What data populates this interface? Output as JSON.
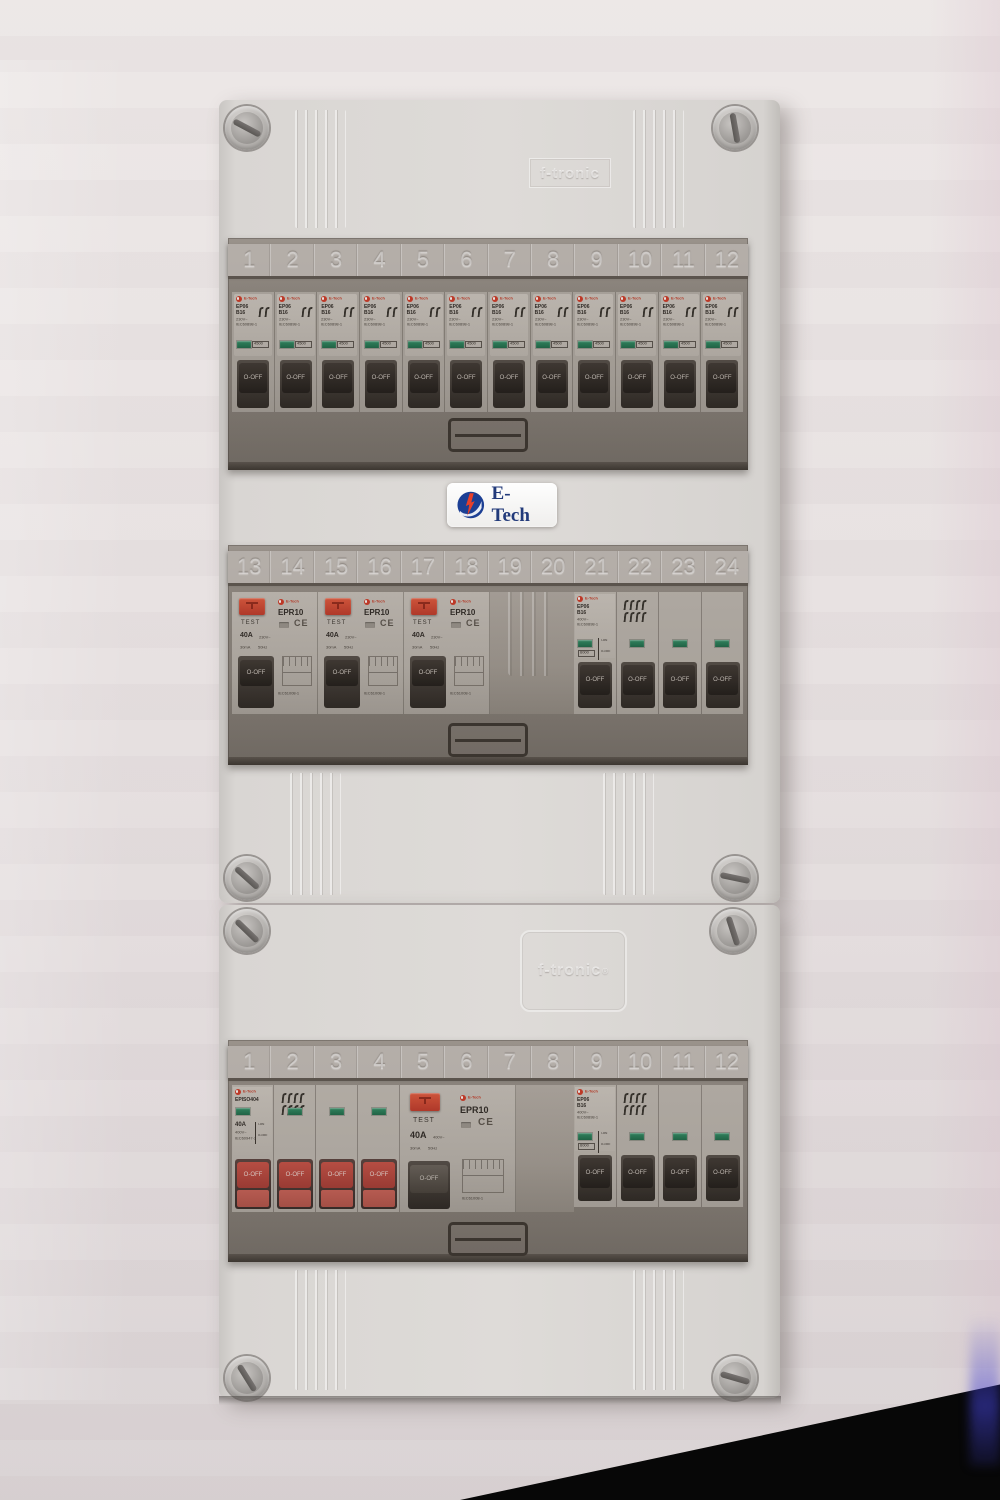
{
  "enclosure": {
    "brand_emboss": "f-tronic",
    "brand_emboss_reg": "®",
    "badge_text": "E-Tech"
  },
  "colors": {
    "accent_red_logo": "#c33a26",
    "test_button_red": "#d8432f",
    "toggle_black": "#262220",
    "toggle_red": "#c24a43",
    "indicator_green": "#2f9067",
    "enclosure_gray": "#d9d6d3",
    "badge_blue": "#1c3f94"
  },
  "top_row": {
    "slots": [
      "1",
      "2",
      "3",
      "4",
      "5",
      "6",
      "7",
      "8",
      "9",
      "10",
      "11",
      "12"
    ],
    "breaker": {
      "count": 12,
      "brand": "E-Tech",
      "model": "EP06",
      "rating": "B16",
      "voltage": "230V~",
      "standard": "IEC60898-1",
      "breaking_capacity": "4500",
      "toggle_label": "O-OFF"
    }
  },
  "middle_row": {
    "slots": [
      "13",
      "14",
      "15",
      "16",
      "17",
      "18",
      "19",
      "20",
      "21",
      "22",
      "23",
      "24"
    ],
    "rcd": {
      "count": 3,
      "brand": "E-Tech",
      "test_label": "TEST",
      "model": "EPR10",
      "rating": "40A",
      "voltage": "230V~",
      "sensitivity": "30mA",
      "frequency": "50Hz",
      "ce_mark": "CE",
      "standard": "IEC61008-1",
      "toggle_label": "O-OFF"
    },
    "mcb_4p": {
      "poles": 4,
      "brand": "E-Tech",
      "model": "EP06",
      "rating": "B16",
      "voltage": "400V~",
      "standard": "IEC60898-1",
      "breaking_capacity": "6000",
      "on_label": "I-ON",
      "off_label": "O-OFF",
      "toggle_label": "O-OFF"
    }
  },
  "bottom_row": {
    "slots": [
      "1",
      "2",
      "3",
      "4",
      "5",
      "6",
      "7",
      "8",
      "9",
      "10",
      "11",
      "12"
    ],
    "isolator": {
      "poles": 4,
      "brand": "E-Tech",
      "model": "EPISO404",
      "rating": "40A",
      "voltage": "400V~",
      "standard": "IEC60947-3",
      "on_label": "I-ON",
      "off_label": "O-OFF",
      "toggle_label": "O-OFF"
    },
    "rcd_4p": {
      "brand": "E-Tech",
      "test_label": "TEST",
      "model": "EPR10",
      "rating": "40A",
      "voltage": "400V~",
      "sensitivity": "30mA",
      "frequency": "50Hz",
      "ce_mark": "CE",
      "standard": "IEC61008-1",
      "toggle_label": "O-OFF"
    },
    "mcb_4p": {
      "poles": 4,
      "brand": "E-Tech",
      "model": "EP06",
      "rating": "B16",
      "voltage": "400V~",
      "standard": "IEC60898-1",
      "breaking_capacity": "6000",
      "on_label": "I-ON",
      "off_label": "O-OFF",
      "toggle_label": "O-OFF"
    }
  }
}
